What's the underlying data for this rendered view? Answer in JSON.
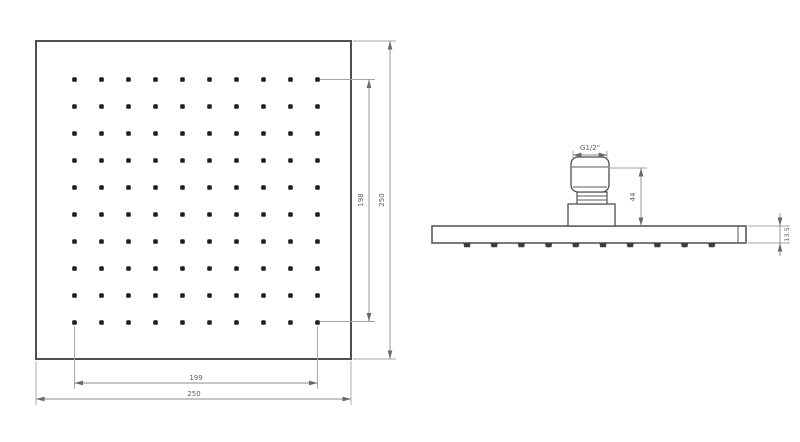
{
  "drawing": {
    "type": "shower-head-technical-drawing",
    "face_view": {
      "dim_field_h": "198",
      "dim_overall_h": "250",
      "dim_field_w": "199",
      "dim_overall_w": "250",
      "nozzle_rows": 10,
      "nozzle_cols": 10
    },
    "side_view": {
      "dim_thread": "G1/2\"",
      "dim_height": "44",
      "dim_thickness": "13.5",
      "nozzle_count": 10
    },
    "colors": {
      "background": "#ffffff",
      "outline": "#4f4f4f",
      "nozzle_dot": "#1e1e1e",
      "dimension_line": "#8c8c8c",
      "dimension_text": "#5f5f5f"
    }
  }
}
